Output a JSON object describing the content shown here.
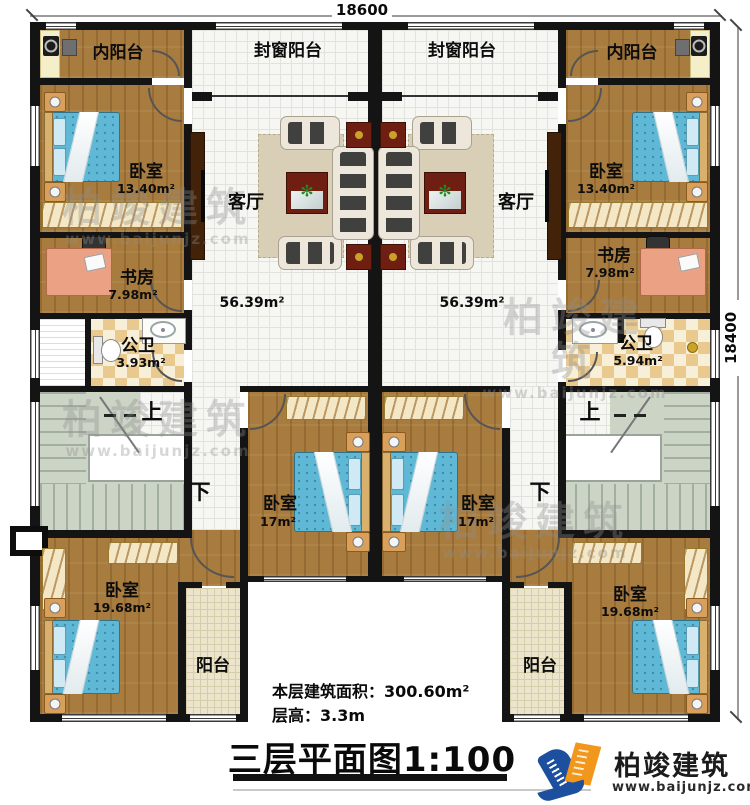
{
  "dimensions": {
    "top": "18600",
    "right": "18400"
  },
  "rooms": {
    "inner_balcony_left": {
      "label": "内阳台"
    },
    "inner_balcony_right": {
      "label": "内阳台"
    },
    "sealed_balcony_left": {
      "label": "封窗阳台"
    },
    "sealed_balcony_right": {
      "label": "封窗阳台"
    },
    "bedroom_top_left": {
      "label": "卧室",
      "area": "13.40m²"
    },
    "bedroom_top_right": {
      "label": "卧室",
      "area": "13.40m²"
    },
    "living_left": {
      "label": "客厅",
      "area": "56.39m²"
    },
    "living_right": {
      "label": "客厅",
      "area": "56.39m²"
    },
    "study_left": {
      "label": "书房",
      "area": "7.98m²"
    },
    "study_right": {
      "label": "书房",
      "area": "7.98m²"
    },
    "bath_left": {
      "label": "公卫",
      "area": "3.93m²"
    },
    "bath_right": {
      "label": "公卫",
      "area": "5.94m²"
    },
    "bedroom_mid_left": {
      "label": "卧室",
      "area": "17m²"
    },
    "bedroom_mid_right": {
      "label": "卧室",
      "area": "17m²"
    },
    "bedroom_bottom_left": {
      "label": "卧室",
      "area": "19.68m²"
    },
    "bedroom_bottom_right": {
      "label": "卧室",
      "area": "19.68m²"
    },
    "balcony_left": {
      "label": "阳台"
    },
    "balcony_right": {
      "label": "阳台"
    }
  },
  "stairs": {
    "up": "上",
    "down": "下"
  },
  "info": {
    "floor_area": "本层建筑面积：300.60m²",
    "floor_height": "层高：3.3m",
    "title": "三层平面图1:100"
  },
  "brand": {
    "name": "柏竣建筑",
    "url": "www.baijunjz.com"
  },
  "watermark": {
    "name": "柏竣建筑",
    "url": "www.baijunjz.com"
  },
  "colors": {
    "wall": "#141414",
    "wood": "#a87c3e",
    "tile": "#f6f6f3",
    "tileline": "#e3e3de",
    "balc": "#ece5cc",
    "balcline": "#d6cdaa",
    "chk1": "#e9c98e",
    "chk2": "#f8efd9",
    "stair": "#ccd4c6",
    "stairline": "#a2ae9f",
    "bed": "#5fb9d6",
    "red": "#6e1f12",
    "blue": "#1c4f9e",
    "orange": "#f0971c",
    "wm": "#8f8f8f"
  }
}
